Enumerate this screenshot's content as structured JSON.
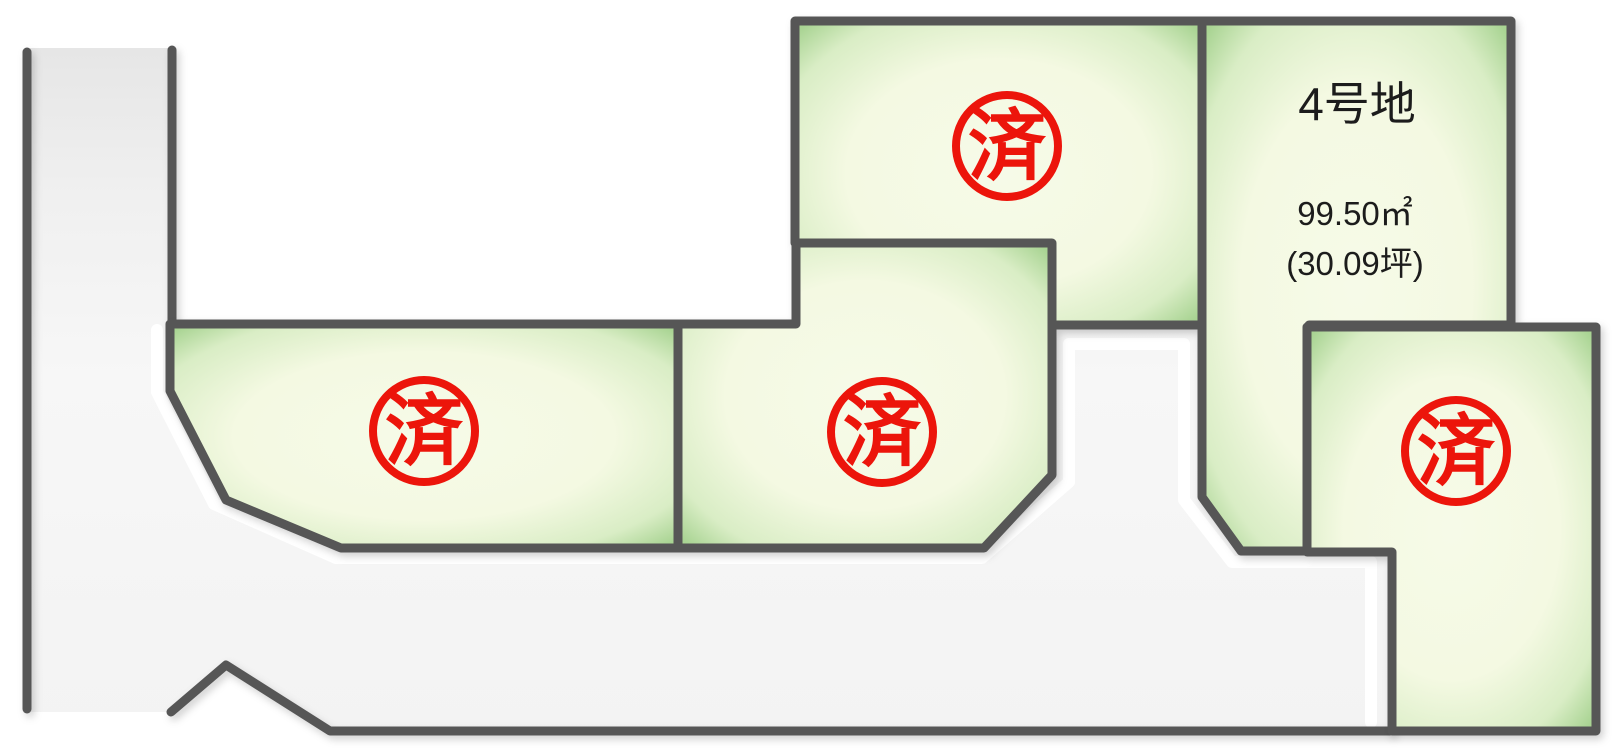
{
  "map": {
    "type": "residential-lot-map",
    "background": "#ffffff"
  },
  "colors": {
    "border_gray": "#575757",
    "road_fill_top": "#e6e6e6",
    "road_fill": "#f5f5f5",
    "road_highlight": "#ffffff",
    "plot_center_green": "#f5f9e3",
    "plot_edge_green": "#a9d493",
    "stamp_red": "#ec150b",
    "label_text": "#1c1c1c"
  },
  "plots": [
    {
      "key": "left",
      "status": "sold",
      "stamp_label": "済"
    },
    {
      "key": "center",
      "status": "sold",
      "stamp_label": "済"
    },
    {
      "key": "top-middle",
      "status": "sold",
      "stamp_label": "済"
    },
    {
      "key": "bottom-right",
      "status": "sold",
      "stamp_label": "済"
    },
    {
      "key": "lot-4",
      "status": "available",
      "name_label": "4号地",
      "area_label": "99.50㎡",
      "tsubo_label": "(30.09坪)"
    }
  ]
}
